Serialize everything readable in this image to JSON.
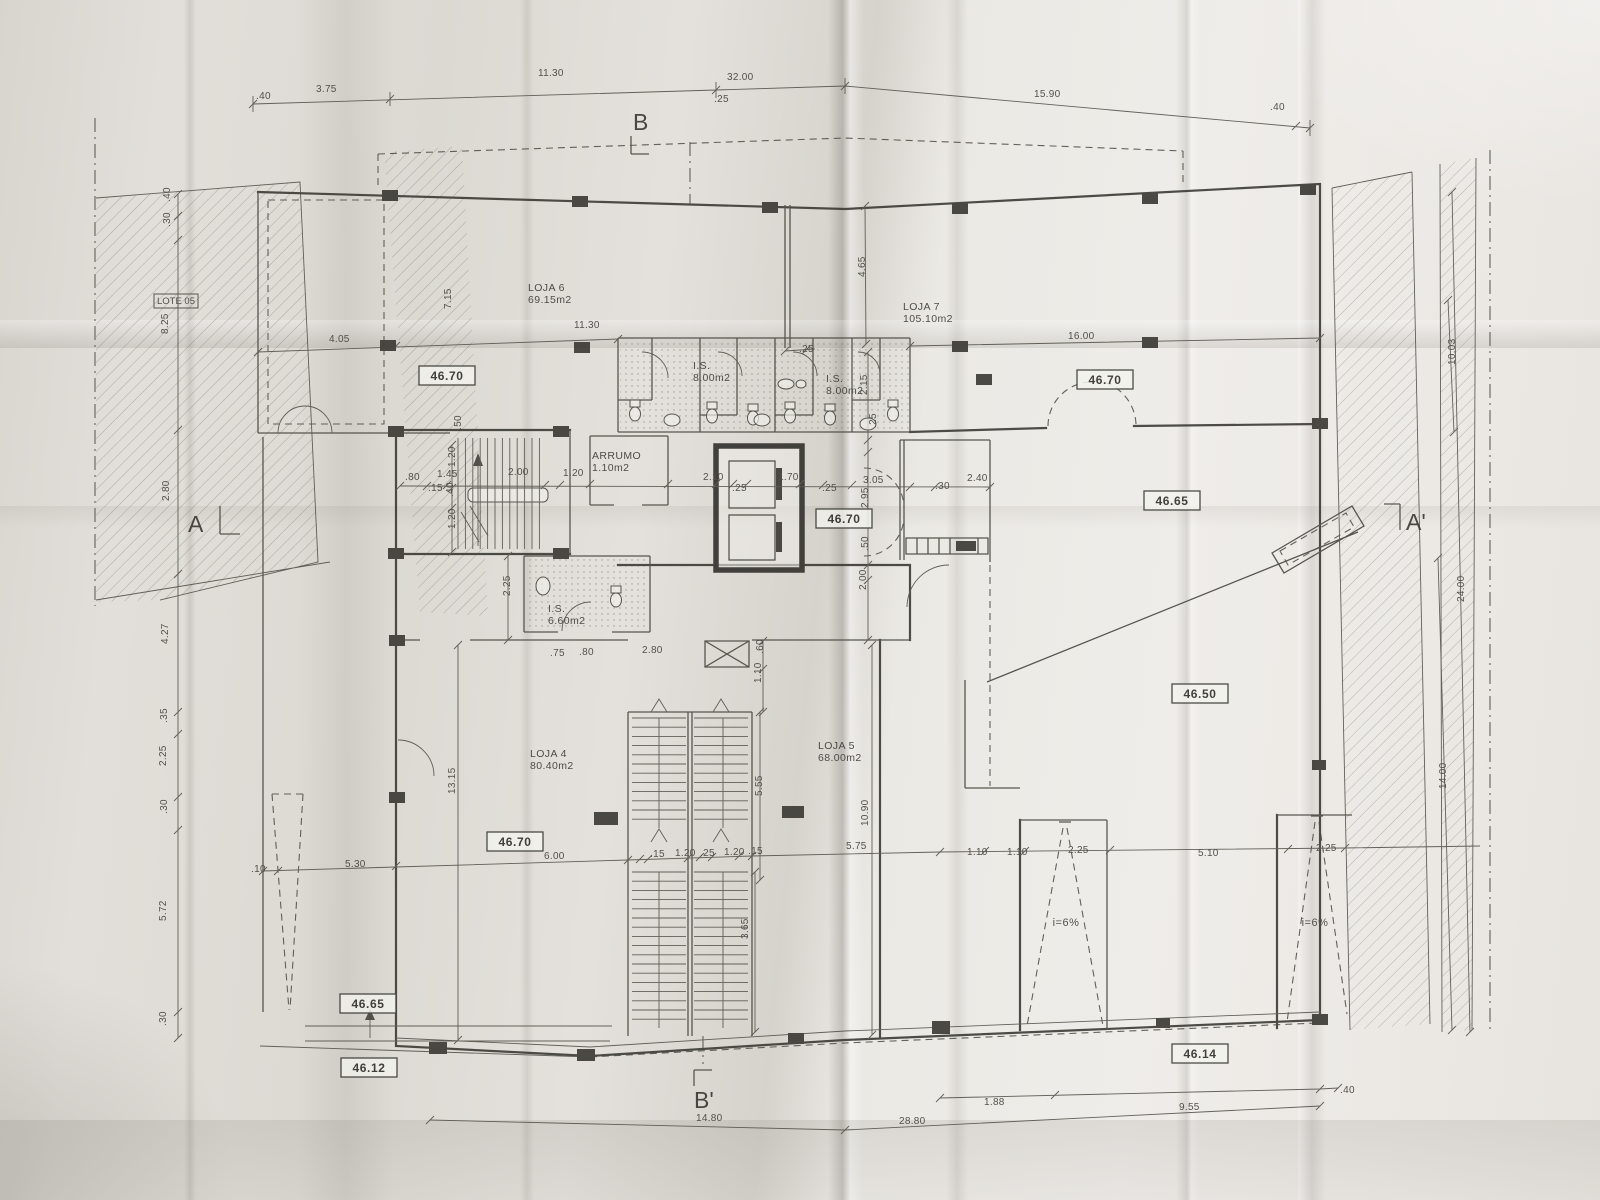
{
  "plan": {
    "markers": {
      "b": "B",
      "b_prime": "B'",
      "a": "A",
      "a_prime": "A'"
    },
    "lot": {
      "label": "LOTE 05"
    },
    "ramp_slope": "i=6%",
    "rooms": {
      "loja6": {
        "name": "LOJA 6",
        "area": "69.15m2"
      },
      "loja7": {
        "name": "LOJA 7",
        "area": "105.10m2"
      },
      "loja4": {
        "name": "LOJA 4",
        "area": "80.40m2"
      },
      "loja5": {
        "name": "LOJA 5",
        "area": "68.00m2"
      },
      "is_top_left": {
        "name": "I.S.",
        "area": "8.00m2"
      },
      "is_top_right": {
        "name": "I.S.",
        "area": "8.00m2"
      },
      "is_mid": {
        "name": "I.S.",
        "area": "6.60m2"
      },
      "arrumo": {
        "name": "ARRUMO",
        "area": "1.10m2"
      }
    },
    "levels": [
      "46.70",
      "46.70",
      "46.70",
      "46.70",
      "46.65",
      "46.50",
      "46.65",
      "46.12",
      "46.14"
    ],
    "dims": [
      {
        "t": ".40",
        "x": 256,
        "y": 99
      },
      {
        "t": "3.75",
        "x": 316,
        "y": 92
      },
      {
        "t": "11.30",
        "x": 538,
        "y": 76
      },
      {
        "t": "32.00",
        "x": 727,
        "y": 80
      },
      {
        "t": ".25",
        "x": 714,
        "y": 102
      },
      {
        "t": "15.90",
        "x": 1034,
        "y": 97
      },
      {
        "t": ".40",
        "x": 1270,
        "y": 110
      },
      {
        "t": ".40",
        "x": 170,
        "y": 202,
        "r": -90
      },
      {
        "t": ".30",
        "x": 170,
        "y": 227,
        "r": -90
      },
      {
        "t": "8.25",
        "x": 168,
        "y": 334,
        "r": -90
      },
      {
        "t": "2.80",
        "x": 169,
        "y": 501,
        "r": -90
      },
      {
        "t": "4.27",
        "x": 168,
        "y": 644,
        "r": -90
      },
      {
        "t": ".35",
        "x": 167,
        "y": 723,
        "r": -90
      },
      {
        "t": "2.25",
        "x": 166,
        "y": 766,
        "r": -90
      },
      {
        "t": ".30",
        "x": 167,
        "y": 814,
        "r": -90
      },
      {
        "t": "5.72",
        "x": 166,
        "y": 921,
        "r": -90
      },
      {
        "t": ".30",
        "x": 166,
        "y": 1026,
        "r": -90
      },
      {
        "t": "4.05",
        "x": 329,
        "y": 342
      },
      {
        "t": "7.15",
        "x": 451,
        "y": 309,
        "r": -90
      },
      {
        "t": "11.30",
        "x": 574,
        "y": 328
      },
      {
        "t": "4.65",
        "x": 865,
        "y": 277,
        "r": -90
      },
      {
        "t": "16.00",
        "x": 1068,
        "y": 339
      },
      {
        "t": ".25",
        "x": 799,
        "y": 352
      },
      {
        "t": "2.15",
        "x": 867,
        "y": 395,
        "r": -90
      },
      {
        "t": ".25",
        "x": 876,
        "y": 428,
        "r": -90
      },
      {
        "t": ".50",
        "x": 461,
        "y": 430,
        "r": -90
      },
      {
        "t": ".80",
        "x": 405,
        "y": 480
      },
      {
        "t": "1.45",
        "x": 437,
        "y": 477
      },
      {
        "t": ".15",
        "x": 428,
        "y": 491
      },
      {
        "t": "1.20",
        "x": 455,
        "y": 467,
        "r": -90
      },
      {
        "t": "2.00",
        "x": 508,
        "y": 475
      },
      {
        "t": "1.20",
        "x": 563,
        "y": 476
      },
      {
        "t": "2.10",
        "x": 703,
        "y": 480
      },
      {
        "t": ".25",
        "x": 732,
        "y": 491
      },
      {
        "t": "1.70",
        "x": 778,
        "y": 480
      },
      {
        "t": ".25",
        "x": 822,
        "y": 491
      },
      {
        "t": "3.05",
        "x": 863,
        "y": 483
      },
      {
        "t": "2.95",
        "x": 868,
        "y": 508,
        "r": -90
      },
      {
        "t": ".30",
        "x": 935,
        "y": 489
      },
      {
        "t": "2.40",
        "x": 967,
        "y": 481
      },
      {
        "t": ".40",
        "x": 453,
        "y": 497,
        "r": -90
      },
      {
        "t": "1.20",
        "x": 455,
        "y": 529,
        "r": -90
      },
      {
        "t": ".50",
        "x": 868,
        "y": 551,
        "r": -90
      },
      {
        "t": "2.00",
        "x": 866,
        "y": 590,
        "r": -90
      },
      {
        "t": "2.25",
        "x": 510,
        "y": 596,
        "r": -90
      },
      {
        "t": ".75",
        "x": 550,
        "y": 656
      },
      {
        "t": ".80",
        "x": 579,
        "y": 655
      },
      {
        "t": "2.80",
        "x": 642,
        "y": 653
      },
      {
        "t": ".60",
        "x": 763,
        "y": 654,
        "r": -90
      },
      {
        "t": "1.10",
        "x": 761,
        "y": 683,
        "r": -90
      },
      {
        "t": "13.15",
        "x": 455,
        "y": 794,
        "r": -90
      },
      {
        "t": "5.55",
        "x": 762,
        "y": 796,
        "r": -90
      },
      {
        "t": "10.90",
        "x": 868,
        "y": 826,
        "r": -90
      },
      {
        "t": "5.75",
        "x": 846,
        "y": 849
      },
      {
        "t": "5.30",
        "x": 345,
        "y": 867
      },
      {
        "t": ".10",
        "x": 251,
        "y": 872
      },
      {
        "t": "6.00",
        "x": 544,
        "y": 859
      },
      {
        "t": ".15",
        "x": 650,
        "y": 857
      },
      {
        "t": "1.20",
        "x": 675,
        "y": 856
      },
      {
        "t": ".25",
        "x": 700,
        "y": 856
      },
      {
        "t": "1.20",
        "x": 724,
        "y": 855
      },
      {
        "t": ".15",
        "x": 748,
        "y": 854
      },
      {
        "t": "3.65",
        "x": 748,
        "y": 939,
        "r": -90
      },
      {
        "t": "1.10",
        "x": 967,
        "y": 855
      },
      {
        "t": "1.10",
        "x": 1007,
        "y": 855
      },
      {
        "t": "2.25",
        "x": 1068,
        "y": 853
      },
      {
        "t": "5.10",
        "x": 1198,
        "y": 856
      },
      {
        "t": "2.25",
        "x": 1316,
        "y": 851
      },
      {
        "t": "24.00",
        "x": 1464,
        "y": 602,
        "r": -90
      },
      {
        "t": "14.00",
        "x": 1446,
        "y": 789,
        "r": -90
      },
      {
        "t": "10.03",
        "x": 1455,
        "y": 365,
        "r": -90
      },
      {
        "t": "14.80",
        "x": 696,
        "y": 1121
      },
      {
        "t": "28.80",
        "x": 899,
        "y": 1124
      },
      {
        "t": "1.88",
        "x": 984,
        "y": 1105
      },
      {
        "t": "9.55",
        "x": 1179,
        "y": 1110
      },
      {
        "t": ".40",
        "x": 1340,
        "y": 1093
      }
    ]
  }
}
